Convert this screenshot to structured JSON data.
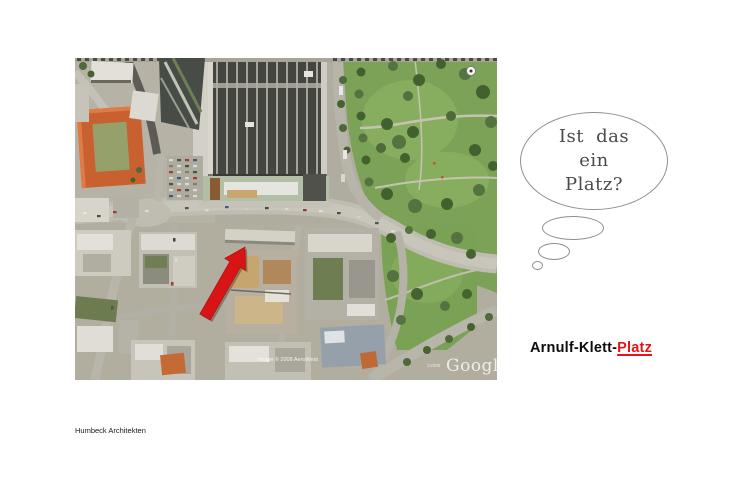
{
  "slide": {
    "background_color": "#ffffff"
  },
  "map": {
    "watermark": "Google",
    "watermark_prefix": "©2008",
    "image_credit": "Image © 2008 AeroWest",
    "arrow_color": "#d81414"
  },
  "thought_bubble": {
    "line1": "Ist das",
    "line2": "ein",
    "line3": "Platz?"
  },
  "title": {
    "prefix": "Arnulf-Klett-",
    "highlight": "Platz",
    "highlight_color": "#e8121a"
  },
  "footer": {
    "credit": "Humbeck Architekten"
  }
}
